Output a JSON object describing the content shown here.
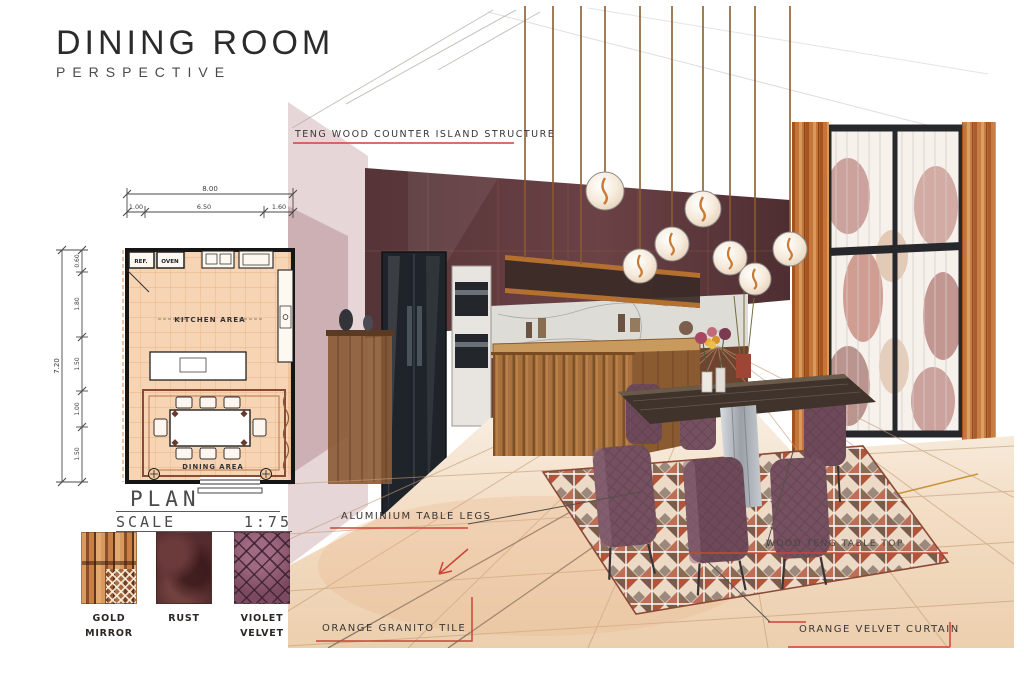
{
  "header": {
    "title": "DINING ROOM",
    "subtitle": "PERSPECTIVE"
  },
  "annotations": {
    "counter_structure": "TENG WOOD COUNTER ISLAND STRUCTURE",
    "table_legs": "ALUMINIUM TABLE LEGS",
    "table_top": "WOOD TENG TABLE TOP",
    "floor_tile": "ORANGE GRANITO TILE",
    "curtain": "ORANGE VELVET CURTAIN"
  },
  "plan": {
    "title": "PLAN",
    "scale_label": "SCALE",
    "scale_value": "1:75",
    "room_labels": {
      "ref": "REF.",
      "oven": "OVEN",
      "kitchen": "KITCHEN AREA",
      "dining": "DINING AREA"
    },
    "dimensions": {
      "top_total": "8.00",
      "top_segments": [
        "1.00",
        "6.50",
        "1.60"
      ],
      "left_total": "7.20",
      "left_segments": [
        "0.60",
        "1.80",
        "1.50",
        "1.00",
        "1.50"
      ]
    }
  },
  "materials": [
    {
      "name": "GOLD MIRROR"
    },
    {
      "name": "RUST"
    },
    {
      "name": "VIOLET VELVET"
    }
  ],
  "colors": {
    "annotation_red": "#cc4437",
    "maroon_cabinet": "#5e3a3d",
    "copper_curtain": "#c4763a",
    "violet_velvet": "#75505f",
    "floor_tan": "#f3e0cd",
    "rug_rust": "#b0543a"
  }
}
